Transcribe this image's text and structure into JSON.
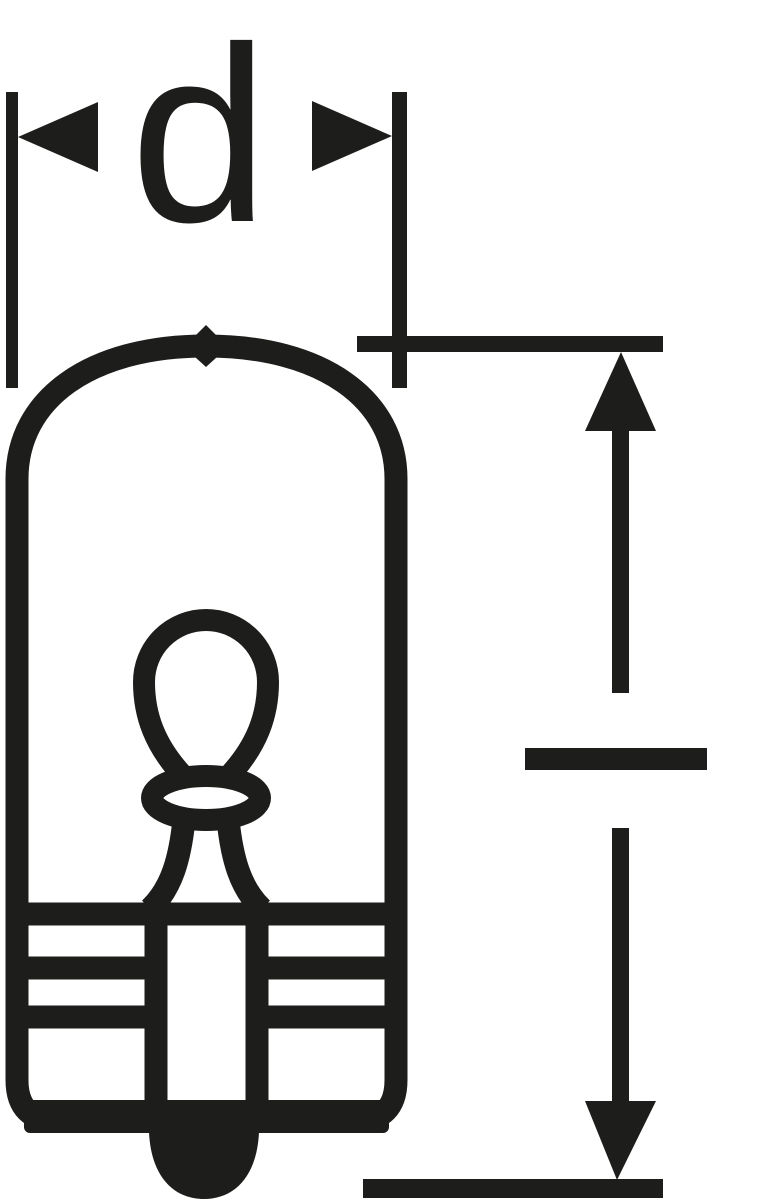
{
  "figure": {
    "type": "technical-line-drawing",
    "subject": "wedge-base miniature bulb, side view with dimension markers",
    "colors": {
      "ink": "#1d1d1b",
      "background": "#ffffff"
    },
    "dimension_markers": [
      {
        "name": "diameter",
        "label": "d",
        "orientation": "horizontal",
        "position": "top",
        "style": "inward-pointing filled triangle arrows between two vertical extension lines"
      },
      {
        "name": "length",
        "label": "",
        "orientation": "vertical",
        "position": "right",
        "style": "outward-pointing filled triangle arrows between two horizontal reference lines, with a perpendicular tick at mid-height"
      }
    ],
    "labels": {
      "diameter": "d"
    }
  }
}
